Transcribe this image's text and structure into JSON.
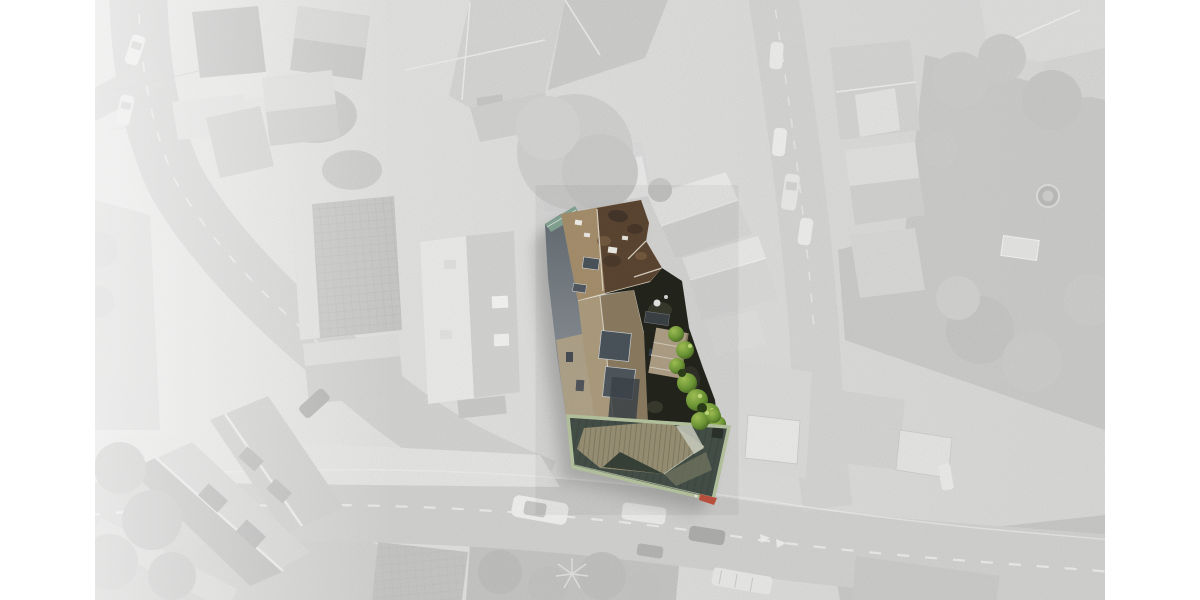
{
  "image": {
    "kind": "aerial-photo-property-highlight",
    "alt": "Faded grayscale aerial photograph of an urban block; one central property shown in full colour with brown tiled roofs, dark inner courtyard, green shrubs and a pale-green glass roof hall"
  },
  "colors": {
    "page_bg": "#ffffff",
    "photo_left": "#ececeb",
    "photo_right": "#dadad9",
    "road": "#d5d5d4",
    "road_marking": "#f6f6f5",
    "building_light": "#efefee",
    "building_mid": "#d4d4d3",
    "building_dark": "#c2c2c1",
    "tree_gray": "#c9c9c8",
    "roof_tan": "#a8916e",
    "roof_brown_dark": "#5d4733",
    "roof_slate_band": "#666e75",
    "facade_tan": "#b4a78b",
    "ridge_light": "#e7e0d2",
    "slate_panel": "#4c555c",
    "courtyard_dark": "#24261d",
    "shed_tan": "#b1a188",
    "bush_green": "#6f9a37",
    "bush_green_light": "#a5c457",
    "bush_green_dark": "#3a531d",
    "teal_edge": "#85a695",
    "glass_frame": "#b9c7a2",
    "glass_dark": "#46514a",
    "glass_khaki": "#9b9377",
    "glass_light_band": "#d0d4c5",
    "accent_red": "#bf5340",
    "shadow": "#7a7a79"
  },
  "highlight": {
    "name": "highlighted-property",
    "parts": [
      "teal-roof-edge",
      "slate-west-roof",
      "tiled-main-roof",
      "roof-skylights",
      "middle-building-roof",
      "inner-courtyard",
      "garden-shed",
      "courtyard-shrubs",
      "glass-roof-hall",
      "red-corner-marker"
    ]
  },
  "background": {
    "elements": [
      "left-diagonal-road",
      "bottom-road",
      "right-road",
      "top-center-building-complex",
      "large-tree",
      "corner-houses",
      "gabled-neighbor-buildings",
      "right-side-houses",
      "gardens",
      "bottom-left-apartment-blocks",
      "garages",
      "trampoline",
      "greenhouse",
      "parked-cars",
      "driving-cars",
      "bus"
    ],
    "car_count": 13
  }
}
